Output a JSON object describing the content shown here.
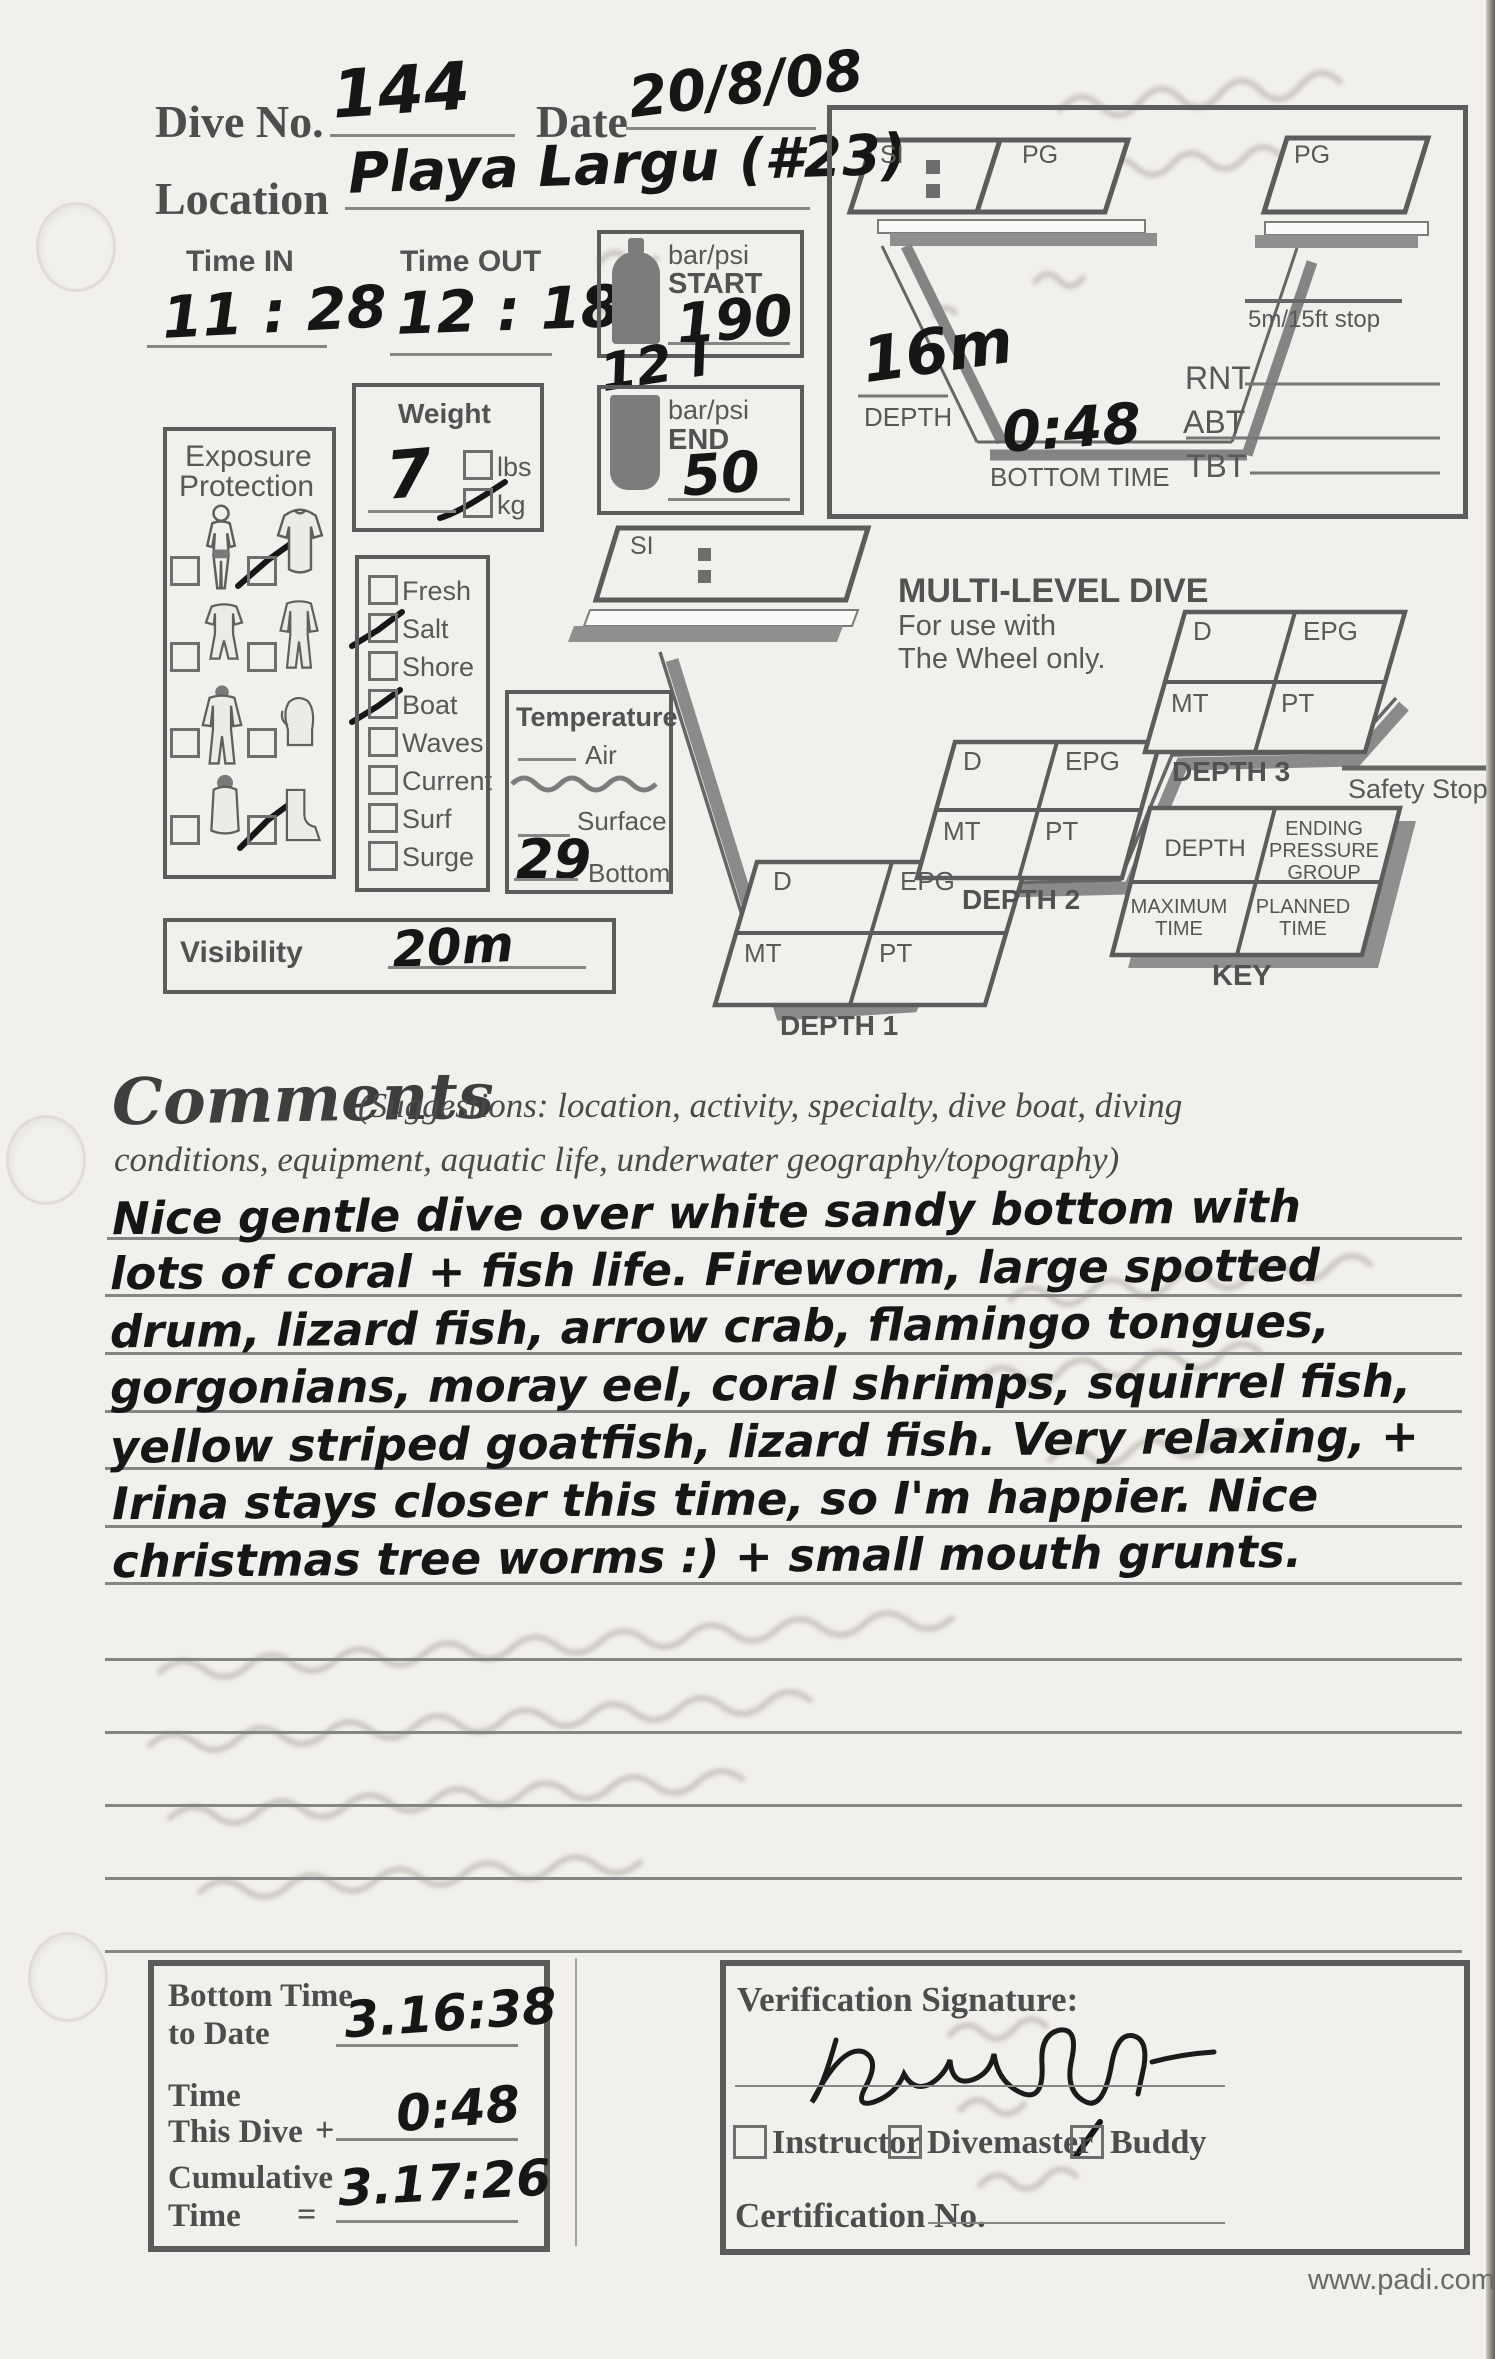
{
  "colors": {
    "paper": "#f2f0ec",
    "printed_ink": "#585858",
    "handwriting_ink": "#161616",
    "shadow_gray": "#8f8f8f"
  },
  "header": {
    "dive_no_label": "Dive No.",
    "dive_no_value": "144",
    "date_label": "Date",
    "date_value": "20/8/08",
    "location_label": "Location",
    "location_value": "Playa Largu (#23)"
  },
  "times": {
    "time_in_label": "Time IN",
    "time_in_value": "11 : 28",
    "time_out_label": "Time OUT",
    "time_out_value": "12 : 18"
  },
  "pressure": {
    "unit_label": "bar/psi",
    "start_label": "START",
    "start_value": "190",
    "tank_note_value": "12 l",
    "end_unit_label": "bar/psi",
    "end_label": "END",
    "end_value": "50"
  },
  "weight": {
    "label": "Weight",
    "value": "7",
    "lbs_label": "lbs",
    "kg_label": "kg",
    "lbs_checked": false,
    "kg_checked": true
  },
  "exposure": {
    "title_line1": "Exposure",
    "title_line2": "Protection",
    "icons": [
      "swimsuit",
      "rash-guard",
      "shorty-wetsuit",
      "full-wetsuit",
      "hooded-wetsuit",
      "gloves",
      "hooded-vest",
      "boots"
    ],
    "checked": [
      "rash-guard",
      "boots"
    ]
  },
  "water_conditions": {
    "options": [
      {
        "label": "Fresh",
        "checked": false
      },
      {
        "label": "Salt",
        "checked": true
      },
      {
        "label": "Shore",
        "checked": false
      },
      {
        "label": "Boat",
        "checked": true
      },
      {
        "label": "Waves",
        "checked": false
      },
      {
        "label": "Current",
        "checked": false
      },
      {
        "label": "Surf",
        "checked": false
      },
      {
        "label": "Surge",
        "checked": false
      }
    ]
  },
  "temperature": {
    "title": "Temperature",
    "air_label": "Air",
    "air_value": "",
    "surface_label": "Surface",
    "surface_value": "",
    "bottom_label": "Bottom",
    "bottom_value": "29"
  },
  "visibility": {
    "label": "Visibility",
    "value": "20m"
  },
  "profile": {
    "si_label": "SI",
    "pg_label1": "PG",
    "pg_label2": "PG",
    "stop_label": "5m/15ft stop",
    "depth_value": "16m",
    "depth_label": "DEPTH",
    "bottom_time_value": "0:48",
    "bottom_time_label": "BOTTOM TIME",
    "rnt_label": "RNT",
    "abt_label": "ABT",
    "tbt_label": "TBT"
  },
  "multilevel": {
    "si_label": "SI",
    "title": "MULTI-LEVEL DIVE",
    "subtitle1": "For use with",
    "subtitle2": "The Wheel only.",
    "cells": {
      "d": "D",
      "epg": "EPG",
      "mt": "MT",
      "pt": "PT"
    },
    "depth1_label": "DEPTH 1",
    "depth2_label": "DEPTH 2",
    "depth3_label": "DEPTH 3",
    "safety_stop_label": "Safety Stop",
    "key": {
      "cell1": "DEPTH",
      "cell2": "ENDING PRESSURE GROUP",
      "cell3": "MAXIMUM TIME",
      "cell4": "PLANNED TIME",
      "label": "KEY"
    }
  },
  "comments": {
    "title": "Comments",
    "suggestions_line1": "(Suggestions: location, activity, specialty, dive boat, diving",
    "suggestions_line2": "conditions, equipment, aquatic life, underwater geography/topography)",
    "lines": [
      "Nice gentle dive over white sandy bottom with",
      "lots of coral + fish life. Fireworm, large spotted",
      "drum, lizard fish, arrow crab, flamingo tongues,",
      "gorgonians, moray eel, coral shrimps, squirrel fish,",
      "yellow striped goatfish, lizard fish. Very relaxing, +",
      "Irina stays closer this time, so I'm happier.  Nice",
      "christmas tree worms :) + small mouth grunts."
    ]
  },
  "totals": {
    "row1_label1": "Bottom Time",
    "row1_label2": "to Date",
    "row1_value": "3.16:38",
    "row2_label1": "Time",
    "row2_label2": "This Dive",
    "row2_operator": "+",
    "row2_value": "0:48",
    "row3_label1": "Cumulative",
    "row3_label2": "Time",
    "row3_operator": "=",
    "row3_value": "3.17:26"
  },
  "verification": {
    "title": "Verification Signature:",
    "options": [
      {
        "label": "Instructor",
        "checked": false
      },
      {
        "label": "Divemaster",
        "checked": false
      },
      {
        "label": "Buddy",
        "checked": true
      }
    ],
    "certification_label": "Certification No."
  },
  "footer": {
    "website": "www.padi.com"
  }
}
